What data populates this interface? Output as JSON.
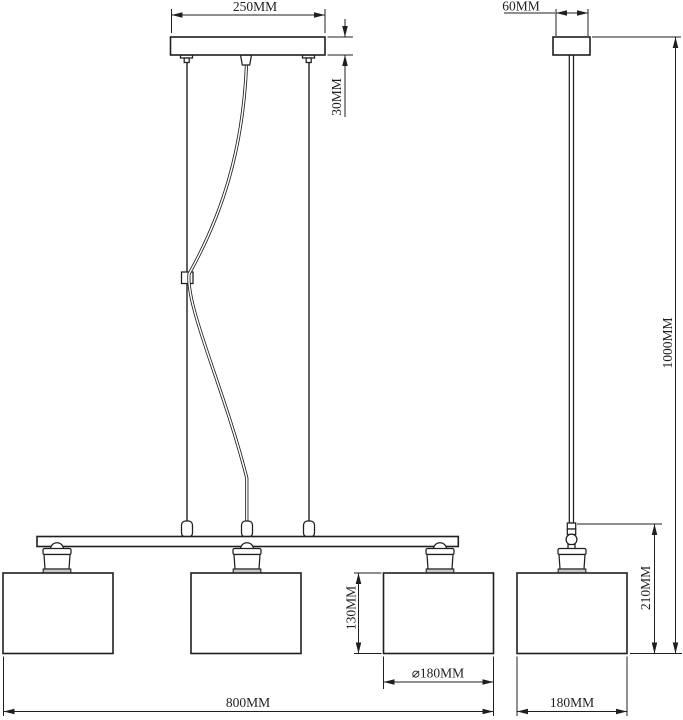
{
  "front_view": {
    "canopy_width_label": "250MM",
    "canopy_height_label": "30MM",
    "shade_height_label": "130MM",
    "shade_diameter_label": "⌀180MM",
    "overall_width_label": "800MM"
  },
  "side_view": {
    "canopy_width_label": "60MM",
    "drop_height_label": "1000MM",
    "fixture_height_label": "210MM",
    "shade_width_label": "180MM"
  },
  "colors": {
    "line": "#1f1f1f",
    "background": "#ffffff",
    "socket_rim": "#c8c8c8"
  }
}
